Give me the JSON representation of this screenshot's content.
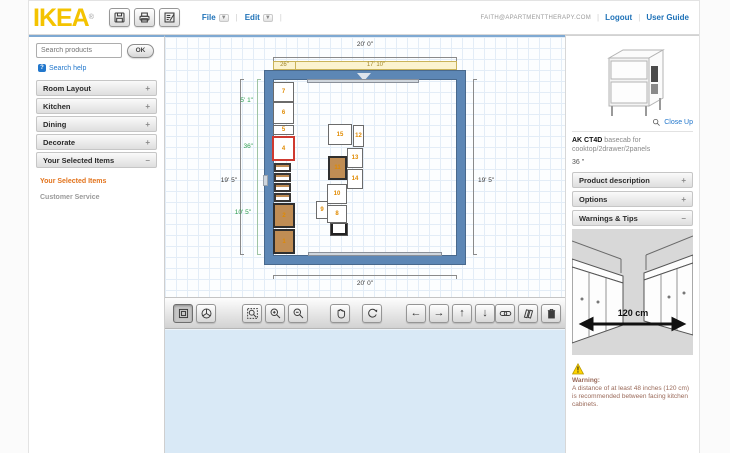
{
  "header": {
    "logo": "IKEA",
    "registered": "®",
    "toolbar": [
      {
        "name": "save"
      },
      {
        "name": "print"
      },
      {
        "name": "item-list"
      }
    ],
    "menus": [
      {
        "label": "File"
      },
      {
        "label": "Edit"
      }
    ],
    "account": {
      "email": "FAITH@APARTMENTTHERAPY.COM",
      "logout": "Logout",
      "user_guide": "User Guide"
    }
  },
  "sidebar": {
    "search_placeholder": "Search products",
    "ok_label": "OK",
    "search_help": "Search help",
    "sections": [
      {
        "label": "Room Layout",
        "state": "+"
      },
      {
        "label": "Kitchen",
        "state": "+"
      },
      {
        "label": "Dining",
        "state": "+"
      },
      {
        "label": "Decorate",
        "state": "+"
      },
      {
        "label": "Your Selected Items",
        "state": "–"
      }
    ],
    "links": [
      {
        "label": "Your Selected Items",
        "color": "#e2731c"
      },
      {
        "label": "Customer Service",
        "color": "#9a9a9a"
      }
    ]
  },
  "plan": {
    "dims": {
      "top_total": "20' 0\"",
      "top_seg_1": "26\"",
      "top_seg_2": "17' 10\"",
      "left_seg_1": "5' 1\"",
      "left_seg_2": "36\"",
      "left_total": "19' 5\"",
      "left_seg_3": "10' 5\"",
      "right_total": "19' 5\"",
      "bottom_total": "20' 0\""
    },
    "items": [
      {
        "label": "7",
        "x": 108,
        "y": 45,
        "w": 21,
        "h": 20,
        "type": "cabinet"
      },
      {
        "label": "6",
        "x": 108,
        "y": 65,
        "w": 21,
        "h": 22,
        "type": "cabinet"
      },
      {
        "label": "5",
        "x": 108,
        "y": 88,
        "w": 21,
        "h": 10,
        "type": "cabinet"
      },
      {
        "label": "4",
        "x": 107,
        "y": 99,
        "w": 23,
        "h": 25,
        "type": "selected"
      },
      {
        "label": "",
        "x": 109,
        "y": 126,
        "w": 17,
        "h": 9,
        "type": "drawer"
      },
      {
        "label": "",
        "x": 109,
        "y": 136,
        "w": 17,
        "h": 9,
        "type": "drawer"
      },
      {
        "label": "",
        "x": 109,
        "y": 146,
        "w": 17,
        "h": 9,
        "type": "drawer"
      },
      {
        "label": "",
        "x": 109,
        "y": 156,
        "w": 17,
        "h": 9,
        "type": "drawer"
      },
      {
        "label": "2",
        "x": 108,
        "y": 166,
        "w": 22,
        "h": 25,
        "type": "wood"
      },
      {
        "label": "1",
        "x": 108,
        "y": 192,
        "w": 22,
        "h": 25,
        "type": "wood"
      },
      {
        "label": "15",
        "x": 163,
        "y": 87,
        "w": 24,
        "h": 21,
        "type": "cabinet"
      },
      {
        "label": "12",
        "x": 188,
        "y": 88,
        "w": 11,
        "h": 22,
        "type": "cabinet"
      },
      {
        "label": "13",
        "x": 182,
        "y": 111,
        "w": 16,
        "h": 20,
        "type": "cabinet"
      },
      {
        "label": "11",
        "x": 163,
        "y": 119,
        "w": 19,
        "h": 24,
        "type": "wood"
      },
      {
        "label": "14",
        "x": 182,
        "y": 132,
        "w": 16,
        "h": 20,
        "type": "cabinet"
      },
      {
        "label": "10",
        "x": 162,
        "y": 147,
        "w": 20,
        "h": 20,
        "type": "cabinet"
      },
      {
        "label": "9",
        "x": 151,
        "y": 164,
        "w": 12,
        "h": 18,
        "type": "cabinet"
      },
      {
        "label": "8",
        "x": 162,
        "y": 168,
        "w": 20,
        "h": 18,
        "type": "cabinet"
      },
      {
        "label": "",
        "x": 165,
        "y": 186,
        "w": 18,
        "h": 13,
        "type": "sink"
      },
      {
        "label": "",
        "x": 142,
        "y": 42,
        "w": 112,
        "h": 4,
        "type": "window"
      },
      {
        "label": "",
        "x": 143,
        "y": 215,
        "w": 134,
        "h": 4,
        "type": "window"
      }
    ]
  },
  "viewbar": {
    "groups": [
      [
        {
          "name": "view-2d",
          "selected": true
        },
        {
          "name": "view-3d"
        }
      ],
      [
        {
          "name": "zoom-fit"
        },
        {
          "name": "zoom-in"
        },
        {
          "name": "zoom-out"
        }
      ],
      [
        {
          "name": "pan"
        }
      ],
      [
        {
          "name": "rotate"
        }
      ],
      [
        {
          "name": "move-left"
        },
        {
          "name": "move-right"
        },
        {
          "name": "move-up"
        },
        {
          "name": "move-down"
        }
      ],
      [
        {
          "name": "link"
        },
        {
          "name": "catalog"
        },
        {
          "name": "delete"
        }
      ]
    ]
  },
  "product": {
    "close_up": "Close Up",
    "code": "AK CT4D",
    "name": "basecab for cooktop/2drawer/2panels",
    "size": "36 \"",
    "sections": [
      {
        "label": "Product description",
        "state": "+"
      },
      {
        "label": "Options",
        "state": "+"
      },
      {
        "label": "Warnings & Tips",
        "state": "–"
      }
    ],
    "diagram_label": "120 cm",
    "warning_title": "Warning:",
    "warning_body": "A distance of at least 48 inches (120 cm) is recommended between facing kitchen cabinets."
  },
  "colors": {
    "accent_blue": "#1f72b8",
    "ikea_yellow": "#f4c300",
    "wall_blue": "#5d87b5",
    "selection_red": "#cf3a30",
    "item_number_orange": "#e08a00",
    "dim_green": "#2e9e4f",
    "lower_canvas_blue": "#d9e9f6"
  }
}
